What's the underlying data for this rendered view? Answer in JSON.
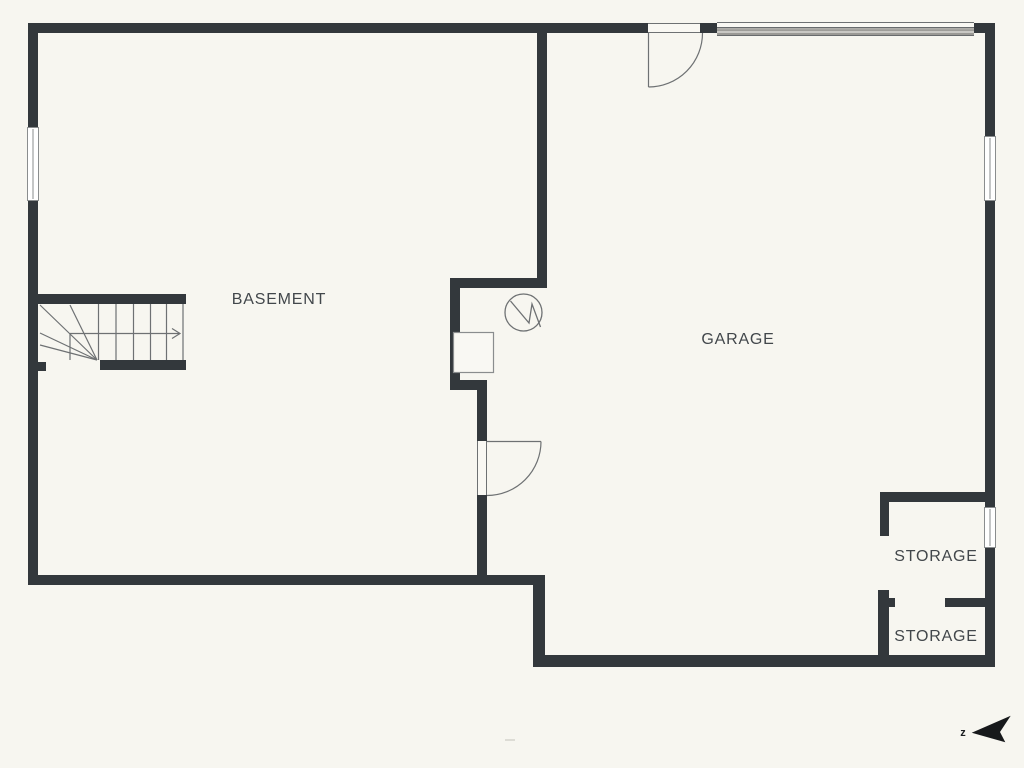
{
  "page": {
    "type": "residential-floor-plan",
    "level": "basement"
  },
  "palette": {
    "background": "#f7f6f0",
    "wall": "#33383c",
    "thin_line": "#6e7173",
    "window_border": "#8a8d8e",
    "label_text": "#42474b",
    "compass": "#17191b",
    "garage_door_fill": "#b2b1ad"
  },
  "rooms": [
    {
      "name": "basement",
      "label": "BASEMENT"
    },
    {
      "name": "garage",
      "label": "GARAGE"
    },
    {
      "name": "storage-upper",
      "label": "STORAGE"
    },
    {
      "name": "storage-lower",
      "label": "STORAGE"
    }
  ],
  "compass": {
    "label": "z"
  },
  "icons": {
    "north_arrow": "north-arrow-icon",
    "utility_circle": "utility-circle-icon",
    "stairs": "stairs-up-arrow",
    "doors": [
      "swing-door-top",
      "swing-door-basement-garage"
    ],
    "garage_door": "garage-door-panel"
  }
}
